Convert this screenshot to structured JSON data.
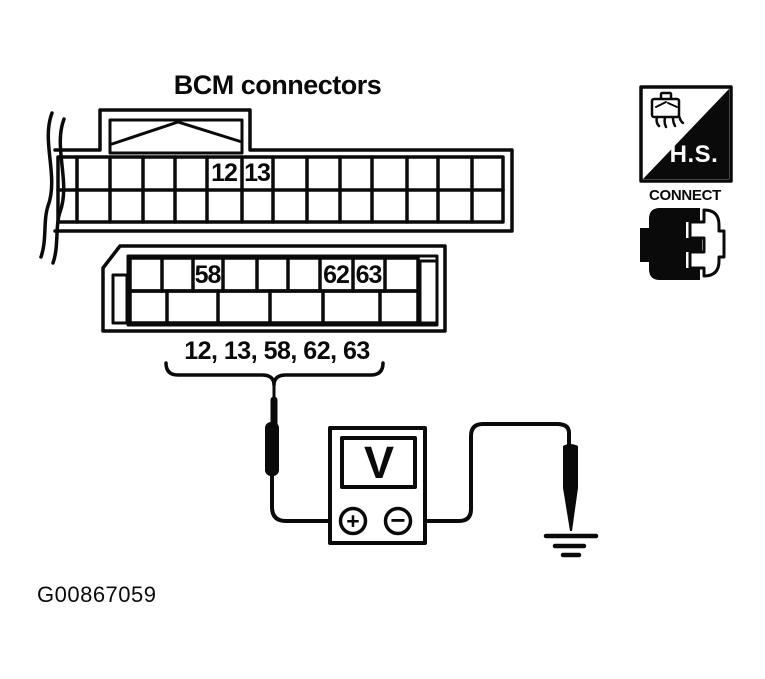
{
  "title": "BCM connectors",
  "figure_id": "G00867059",
  "connector_top": {
    "pin12": "12",
    "pin13": "13"
  },
  "connector_bottom": {
    "pin58": "58",
    "pin62": "62",
    "pin63": "63"
  },
  "pin_list_label": "12, 13, 58, 62, 63",
  "voltmeter": {
    "display": "V",
    "plus_symbol": "+",
    "minus_symbol": "−"
  },
  "badge": {
    "hs_label": "H.S.",
    "connect_label": "CONNECT"
  },
  "icons": {
    "break_marks": "cable-break-icon",
    "latch": "connector-latch-icon",
    "probe_left": "test-probe-icon",
    "probe_right": "test-probe-icon",
    "plus_terminal": "plus-terminal-icon",
    "minus_terminal": "minus-terminal-icon",
    "ground": "ground-icon",
    "hs_sketch": "connector-sketch-icon",
    "mating_connectors": "mating-connectors-icon"
  },
  "colors": {
    "ink": "#000000",
    "paper": "#ffffff"
  }
}
